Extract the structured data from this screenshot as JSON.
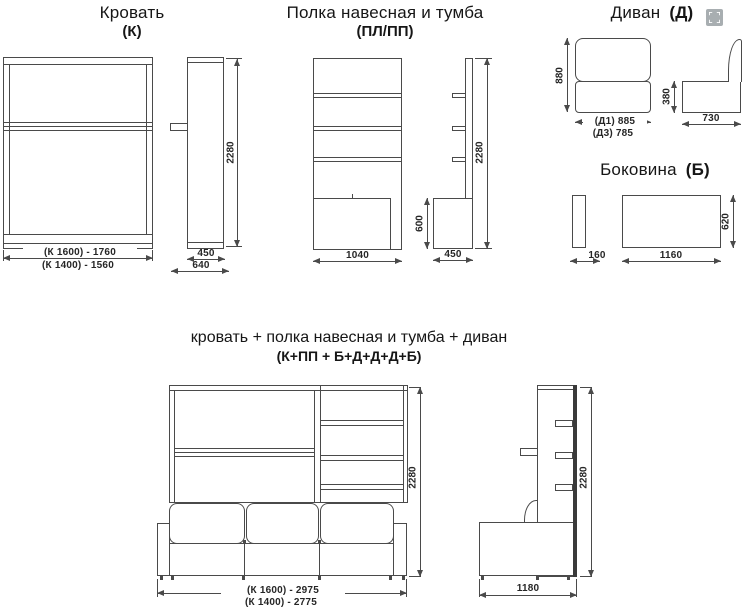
{
  "icons": {
    "fullscreen": "⛶"
  },
  "sections": {
    "bed": {
      "title": "Кровать",
      "code": "(К)",
      "dims": {
        "height": "2280",
        "width_k1600": "(К 1600) - 1760",
        "width_k1400": "(К 1400) - 1560",
        "depth_folded": "450",
        "depth_total": "640"
      }
    },
    "shelf": {
      "title": "Полка навесная и тумба",
      "code": "(ПЛ/ПП)",
      "dims": {
        "width": "1040",
        "height": "2280",
        "cabinet_height": "600",
        "cabinet_depth": "450"
      }
    },
    "sofa": {
      "title": "Диван",
      "code": "(Д)",
      "dims": {
        "height": "880",
        "width_d1": "(Д1) 885",
        "width_d3": "(Д3) 785",
        "seat_height": "380",
        "depth": "730"
      }
    },
    "side_panel": {
      "title": "Боковина",
      "code": "(Б)",
      "dims": {
        "thickness": "160",
        "length": "1160",
        "height": "620"
      }
    },
    "combined": {
      "title": "кровать + полка навесная и тумба + диван",
      "code": "(К+ПП + Б+Д+Д+Д+Б)",
      "dims": {
        "height": "2280",
        "width_k1600": "(К 1600) - 2975",
        "width_k1400": "(К 1400) - 2775",
        "depth": "1180"
      }
    }
  }
}
